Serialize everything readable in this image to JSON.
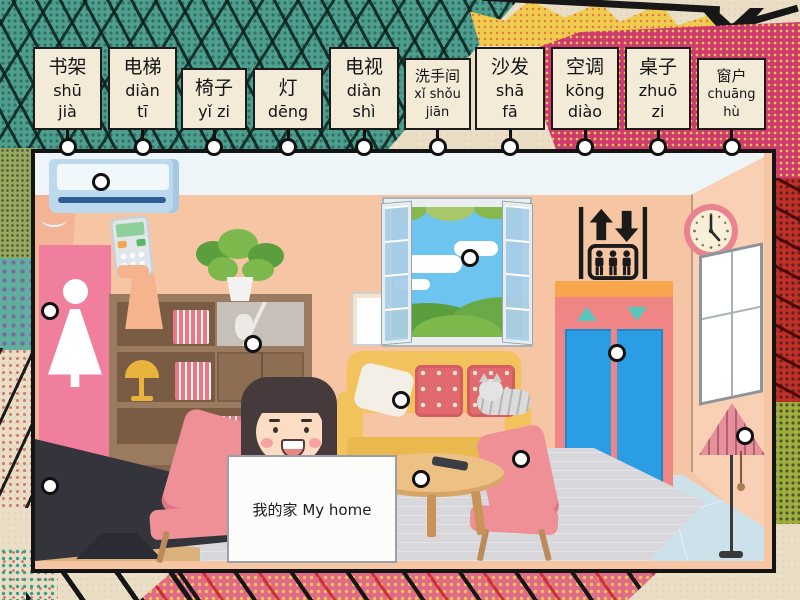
{
  "activity": {
    "sign_text": "我的家 My home"
  },
  "labels": [
    {
      "hanzi": "书架",
      "pinyin": "shū\njià"
    },
    {
      "hanzi": "电梯",
      "pinyin": "diàn\ntī"
    },
    {
      "hanzi": "椅子",
      "pinyin": "yǐ zi"
    },
    {
      "hanzi": "灯",
      "pinyin": "dēng"
    },
    {
      "hanzi": "电视",
      "pinyin": "diàn\nshì"
    },
    {
      "hanzi": "洗手间",
      "pinyin": "xǐ shǒu\njiān"
    },
    {
      "hanzi": "沙发",
      "pinyin": "shā\nfā"
    },
    {
      "hanzi": "空调",
      "pinyin": "kōng\ndiào"
    },
    {
      "hanzi": "桌子",
      "pinyin": "zhuō\nzi"
    },
    {
      "hanzi": "窗户",
      "pinyin": "chuāng\nhù"
    }
  ],
  "targets": [
    "air-conditioner",
    "bathroom-sign",
    "bookshelf",
    "window",
    "elevator",
    "sofa",
    "chair",
    "tv",
    "coffee-table",
    "floor-lamp"
  ],
  "colors": {
    "paper": "#eadfc6",
    "ink": "#1b1b1b",
    "card-bg": "#f3ead8",
    "panel-teal": "#4f9f90",
    "panel-magenta": "#cf3a6e",
    "wall": "#f6c5a4",
    "wall-side": "#f9d0b4",
    "ceiling": "#edf5f8",
    "floor": "#cde1eb",
    "rug": "#d8d8dc",
    "bath-pink": "#f07f9e",
    "elevator-pink": "#f08585",
    "door-blue": "#2b9de4",
    "orange": "#f7a64e",
    "teal": "#55c8bc",
    "sofa-yellow": "#f2c35c",
    "chair-pink": "#ef9097",
    "lamp-pink": "#e88f9c",
    "sky": "#6cc4ef",
    "tv-dark": "#33343c",
    "sign-bg": "#fcfcfa"
  }
}
